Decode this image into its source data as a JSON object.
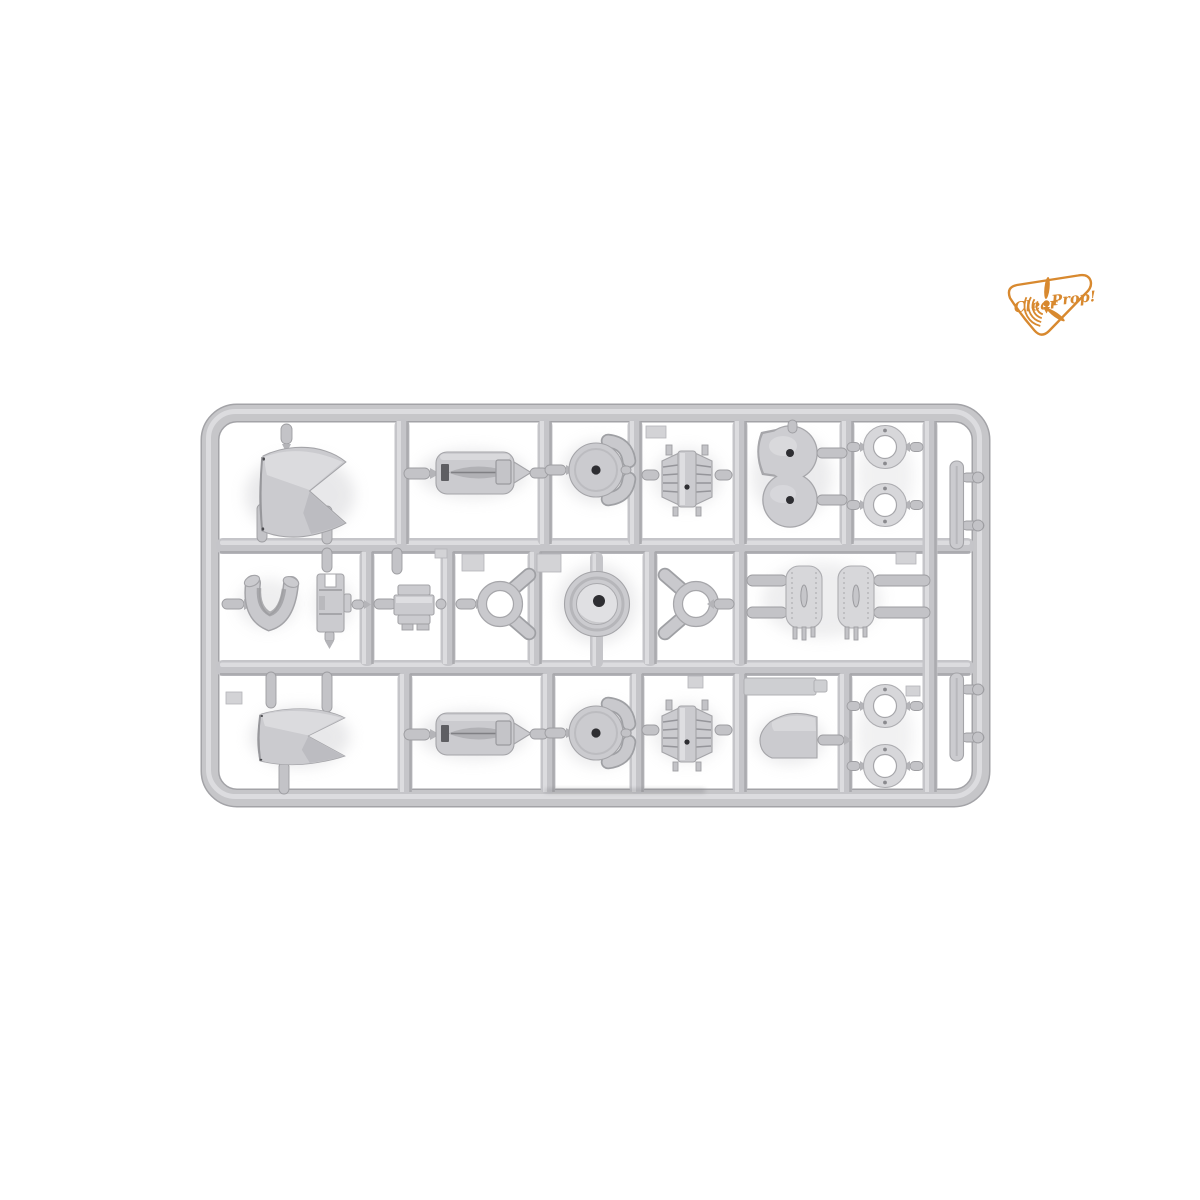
{
  "scene": {
    "background": "#ffffff",
    "subject": "light-gray injection-molded plastic model kit sprue photographed on white"
  },
  "logo": {
    "word1": "Clear",
    "word2": "Prop!",
    "color": "#d8892f"
  },
  "sprue": {
    "plastic_color": "#c6c6c9",
    "highlight_color": "#dedee1",
    "shadow_color": "#a4a4a8",
    "hole_color": "#2e2e32",
    "rows": 3,
    "parts_inventory": [
      {
        "name": "cowling-shell",
        "count": 2
      },
      {
        "name": "engine-cowl-insert",
        "count": 2
      },
      {
        "name": "bulkhead-disc",
        "count": 2
      },
      {
        "name": "elbow-pipe",
        "count": 8
      },
      {
        "name": "ribbed-radiator-core",
        "count": 2
      },
      {
        "name": "twin-hub-plate",
        "count": 1
      },
      {
        "name": "cowl-ring",
        "count": 4
      },
      {
        "name": "blade-strip",
        "count": 2
      },
      {
        "name": "saddle-fairing",
        "count": 1
      },
      {
        "name": "mount-bracket",
        "count": 1
      },
      {
        "name": "equipment-box",
        "count": 1
      },
      {
        "name": "intake-ring",
        "count": 2
      },
      {
        "name": "cowl-front-face",
        "count": 1
      },
      {
        "name": "fuel-tank",
        "count": 2
      },
      {
        "name": "tail-cone-fairing",
        "count": 1
      },
      {
        "name": "flat-strip",
        "count": 1
      }
    ]
  }
}
